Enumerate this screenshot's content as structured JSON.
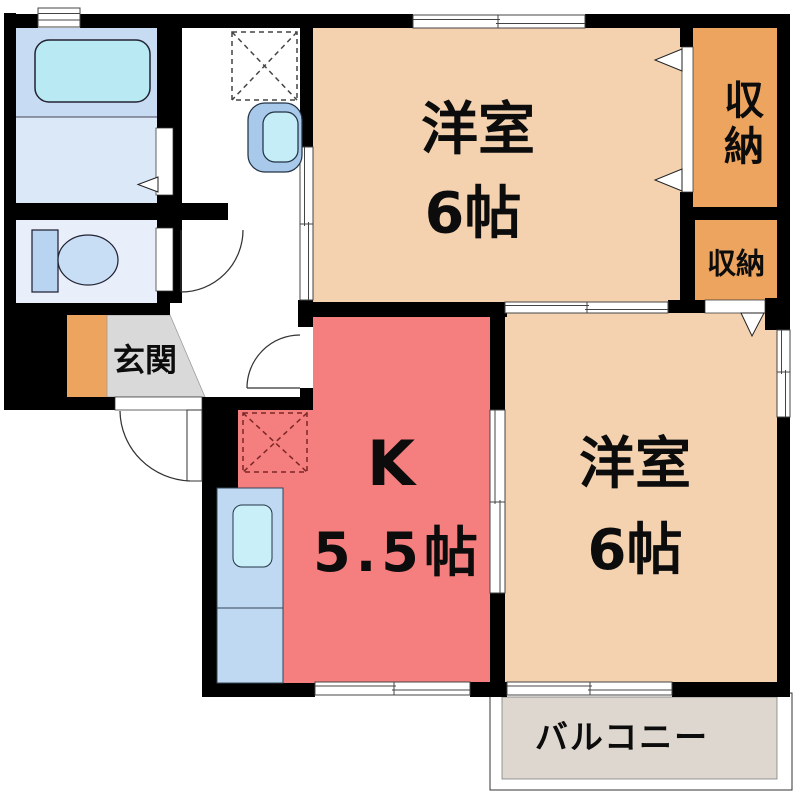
{
  "plan": {
    "kind": "japanese-apartment-floorplan",
    "rooms": {
      "western1": {
        "name": "洋室",
        "size": "6帖"
      },
      "western2": {
        "name": "洋室",
        "size": "6帖"
      },
      "kitchen": {
        "name": "K",
        "size": "5.5帖"
      },
      "storage_upper": {
        "name": "収納"
      },
      "storage_lower": {
        "name": "収納"
      },
      "entrance": {
        "name": "玄関"
      },
      "balcony": {
        "name": "バルコニー"
      }
    },
    "fixtures": [
      "bathtub",
      "vanity-sink",
      "toilet",
      "washing-machine-space",
      "kitchen-sink-counter",
      "refrigerator-space"
    ],
    "colors": {
      "wall": "#000000",
      "room_peach": "#f4d2b0",
      "kitchen_red": "#f57e7e",
      "storage_orange": "#eda45f",
      "entrance_mat_orange": "#eda45f",
      "entrance_floor_gray": "#d9d9d9",
      "balcony_gray": "#ddd7cf",
      "bath_blue": "#c7dbf2",
      "washroom_blue": "#dbe8f7",
      "toilet_room_blue": "#e8effa",
      "bathtub_cyan": "#b9e9f3",
      "toilet_tank_blue": "#b9d4f1",
      "toilet_bowl_blue": "#c8def5",
      "counter_blue": "#c0d9f3",
      "sink_cyan": "#c9f0f8",
      "vanity_blue": "#a9c9ea",
      "vanity_basin_cyan": "#c5edf8",
      "white": "#ffffff"
    }
  }
}
